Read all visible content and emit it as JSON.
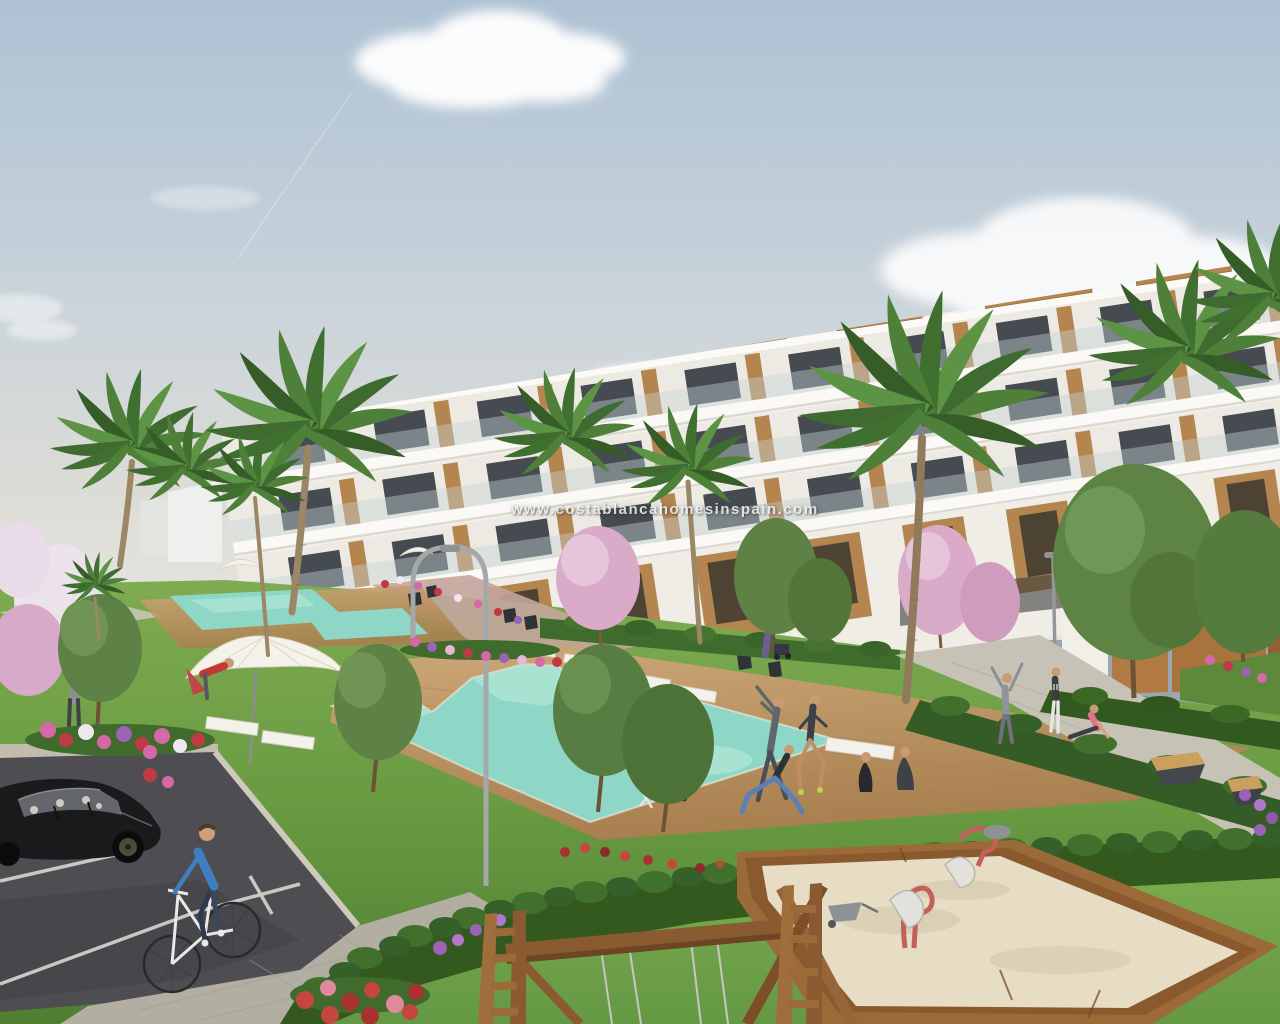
{
  "image": {
    "alt": "3D architectural rendering of a white terraced apartment complex with communal pools, palm trees, lawns, a playground sandbox, a swing frame, parked black car and a cyclist",
    "watermark": "www.costablancahomesinspain.com"
  },
  "palette": {
    "sky_top": "#aec1d3",
    "sky_horizon": "#e7e4de",
    "cloud": "#ffffff",
    "building_white": "#f4f2ec",
    "building_trim": "#dedbd2",
    "wood_cladding": "#b5854f",
    "glass_window": "#454b51",
    "balcony_glass": "#c7d3d6",
    "ochre_wall": "#b07a42",
    "pool_water": "#8ed7c6",
    "pool_shallow": "#b7ead9",
    "deck_wood": "#c19a6a",
    "grass_light": "#79a84c",
    "grass_dark": "#4f7e31",
    "hedge_green": "#33591f",
    "path_grey": "#c6c2b6",
    "path_pink": "#c4a59c",
    "asphalt": "#4e4e52",
    "pavement": "#b2aea2",
    "parking_line": "#d8d6d0",
    "sand": "#e7dcc4",
    "sandbox_wood": "#9c6a38",
    "swing_wood": "#8a5a30",
    "flower_pink": "#d468a8",
    "flower_red": "#bf3a45",
    "flower_purple": "#9a63b5",
    "blossom_pink": "#d9abc9",
    "car_black": "#1a1a1d",
    "cyclist_blue": "#3f7fc1",
    "parasol_white": "#f5f2e9",
    "lamp_grey": "#a4a8a8",
    "skin": "#c99a76"
  }
}
